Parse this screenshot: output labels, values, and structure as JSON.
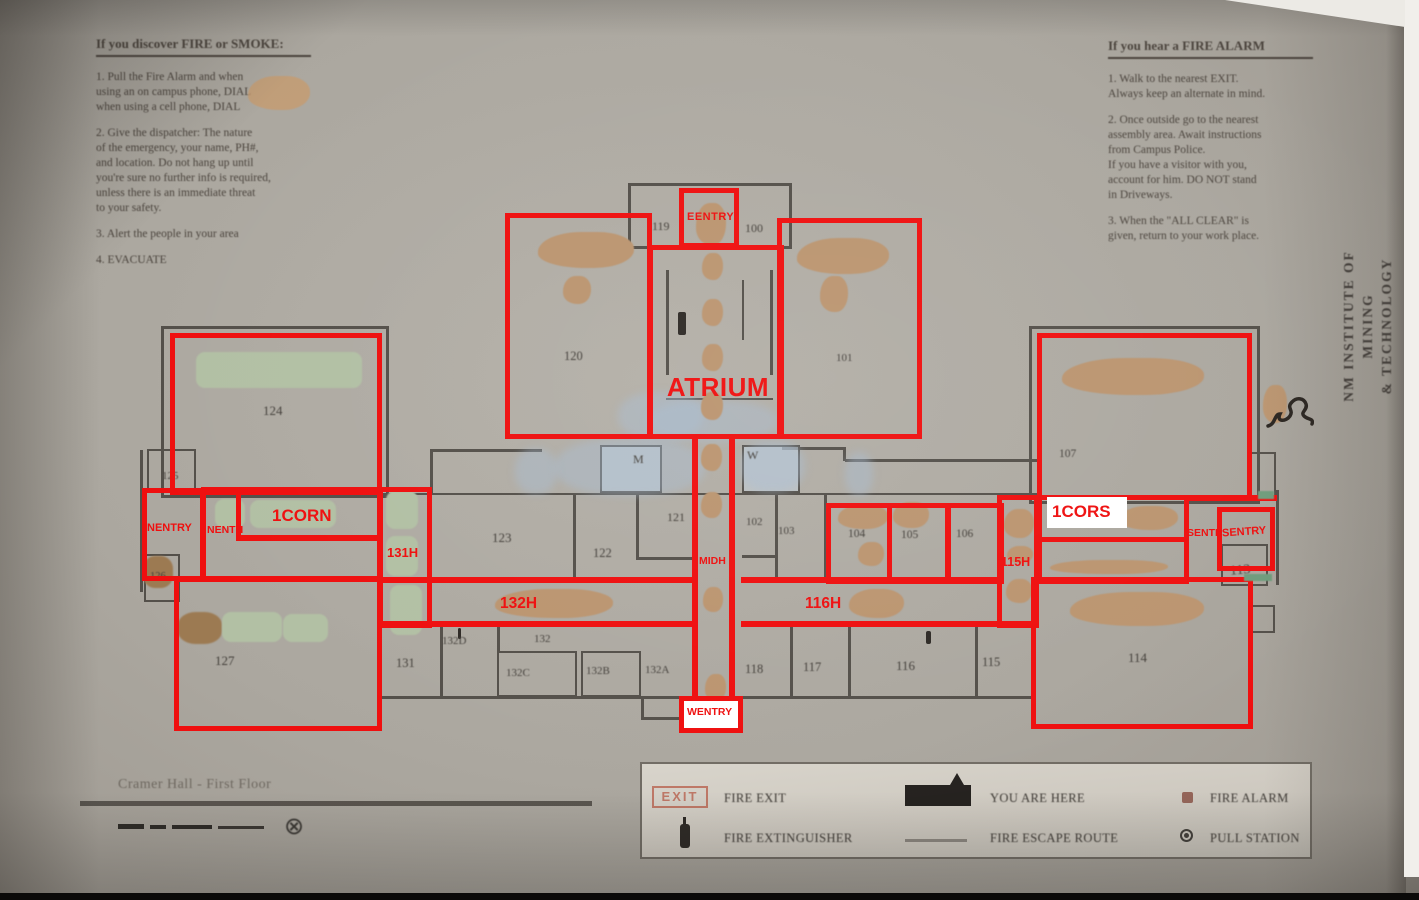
{
  "colors": {
    "annotation_red": "#ef0f0f",
    "plan_line": "#54504a",
    "redaction_tan": "#bb9570",
    "redaction_green": "#b2c0a4",
    "paper": "#aeaaa2"
  },
  "poster": {
    "left_instructions": {
      "title": "If you discover FIRE or SMOKE:",
      "lines": [
        "1. Pull the Fire Alarm and when",
        "using an on campus phone, DIAL",
        "when using a cell phone, DIAL",
        "",
        "2. Give the dispatcher: The nature",
        "of the emergency, your name, PH#,",
        "and location. Do not hang up until",
        "you're sure no further info is required,",
        "unless there is an immediate threat",
        "to your safety.",
        "",
        "3. Alert the people in your area",
        "",
        "4. EVACUATE"
      ]
    },
    "right_instructions": {
      "title": "If you hear a FIRE ALARM",
      "lines": [
        "1. Walk to the nearest EXIT.",
        "Always keep an alternate in mind.",
        "",
        "2. Once outside go to the nearest",
        "assembly area. Await instructions",
        "from Campus Police.",
        "If you have a visitor with you,",
        "account for him. DO NOT stand",
        "in Driveways.",
        "",
        "3. When the \"ALL CLEAR\" is",
        "given, return to your work place."
      ]
    },
    "side_text": {
      "line1": "NM INSTITUTE OF",
      "line2": "MINING",
      "line3": "& TECHNOLOGY"
    }
  },
  "map": {
    "caption": "Cramer Hall - First Floor",
    "rooms": {
      "r119": "119",
      "r100": "100",
      "r120": "120",
      "r101": "101",
      "r124": "124",
      "r125": "125",
      "r126": "126",
      "r127": "127",
      "r123": "123",
      "r122": "122",
      "r121": "121",
      "r102": "102",
      "r103": "103",
      "r104": "104",
      "r105": "105",
      "r106": "106",
      "r107": "107",
      "r131": "131",
      "r132d": "132D",
      "r132": "132",
      "r132c": "132C",
      "r132b": "132B",
      "r132a": "132A",
      "r118": "118",
      "r117": "117",
      "r116": "116",
      "r115": "115",
      "r114": "114",
      "r113": "113",
      "m": "M",
      "w": "W"
    },
    "red_labels": {
      "atrium": "ATRIUM",
      "eentry": "EENTRY",
      "nentry": "NENTRY",
      "nenth": "NENTH",
      "corn": "1CORN",
      "h131": "131H",
      "h132": "132H",
      "midh": "MIDH",
      "h116": "116H",
      "h115": "115H",
      "cors": "1CORS",
      "senth": "SENTH",
      "sentry": "SENTRY",
      "wentry": "WENTRY"
    }
  },
  "legend": {
    "exit_sign_text": "EXIT",
    "items": [
      {
        "icon": "exit-sign-icon",
        "label": "FIRE EXIT"
      },
      {
        "icon": "fire-extinguisher-icon",
        "label": "FIRE EXTINGUISHER"
      },
      {
        "icon": "you-are-here-icon",
        "label": "YOU ARE HERE"
      },
      {
        "icon": "route-line-icon",
        "label": "FIRE ESCAPE ROUTE"
      },
      {
        "icon": "fire-alarm-icon",
        "label": "FIRE ALARM"
      },
      {
        "icon": "pull-station-icon",
        "label": "PULL STATION"
      }
    ]
  }
}
